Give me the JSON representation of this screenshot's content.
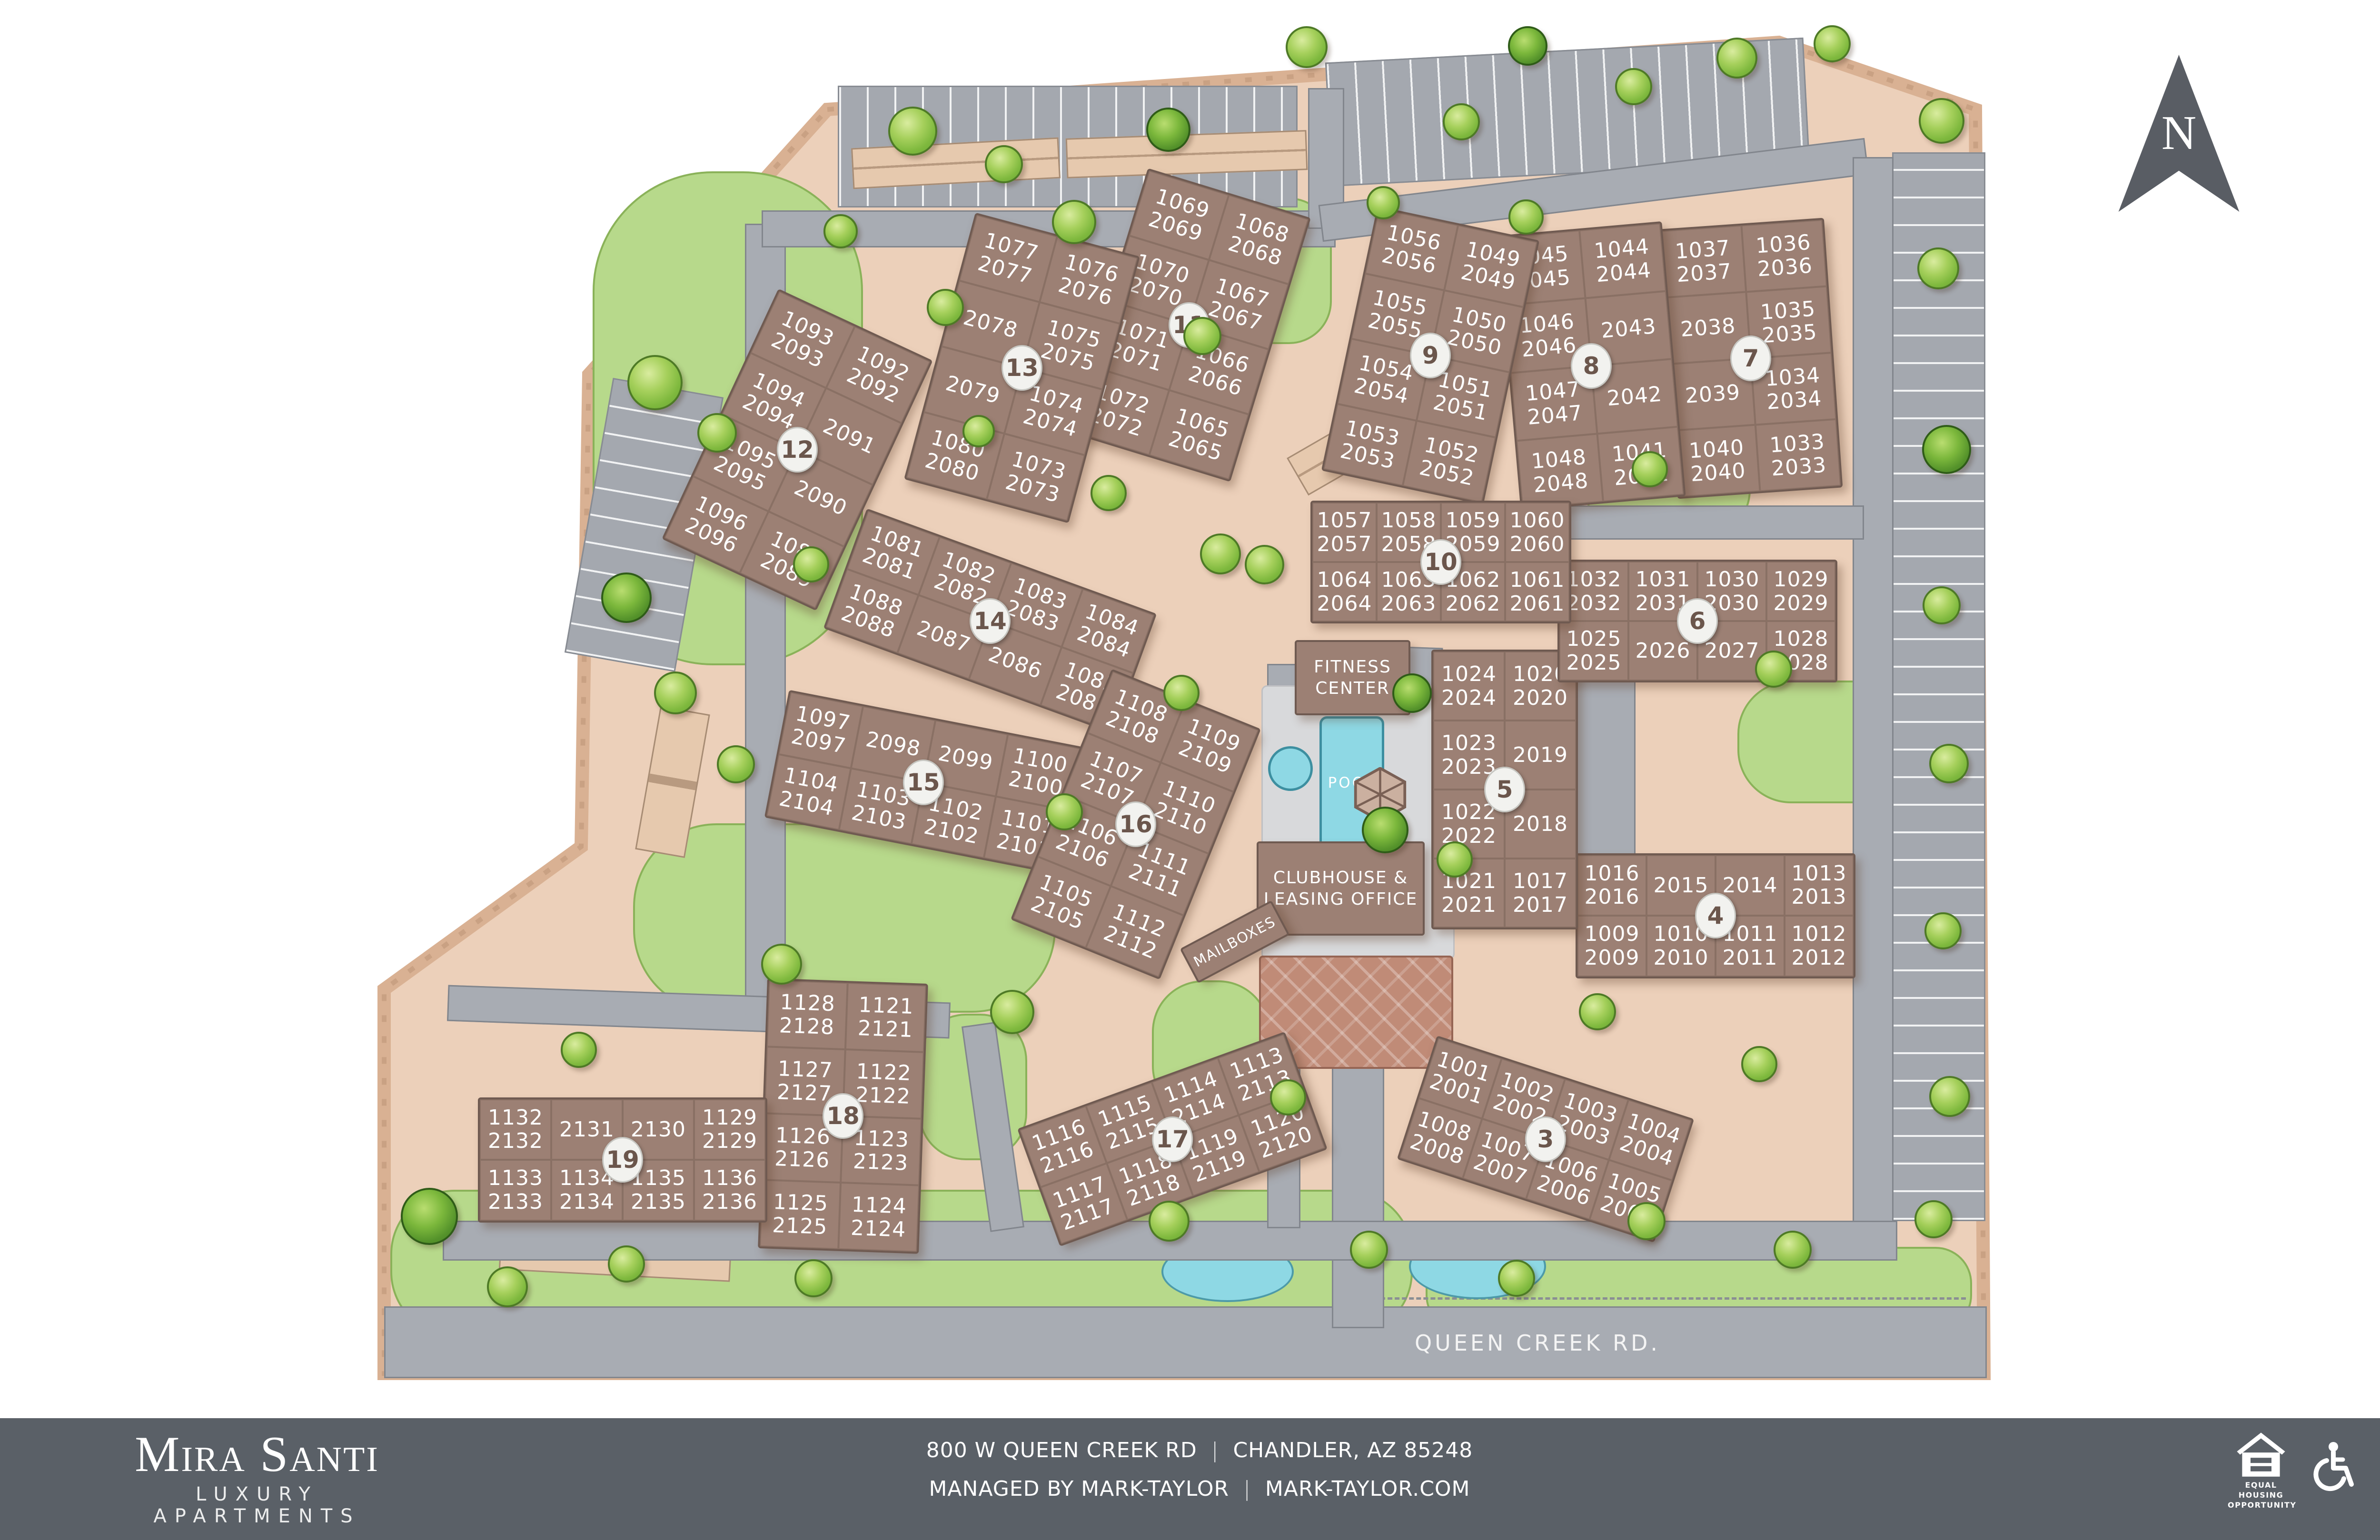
{
  "map": {
    "north_label": "N",
    "road_label": "QUEEN CREEK RD.",
    "amenities": {
      "fitness_line1": "FITNESS",
      "fitness_line2": "CENTER",
      "pool": "POOL",
      "clubhouse_line1": "CLUBHOUSE &",
      "clubhouse_line2": "LEASING OFFICE",
      "mailboxes": "MAILBOXES"
    },
    "buildings": [
      {
        "number": "3",
        "cells": [
          [
            "1001",
            "2001"
          ],
          [
            "1002",
            "2002"
          ],
          [
            "1003",
            "2003"
          ],
          [
            "1004",
            "2004"
          ],
          [
            "1008",
            "2008"
          ],
          [
            "1007",
            "2007"
          ],
          [
            "1006",
            "2006"
          ],
          [
            "1005",
            "2005"
          ]
        ]
      },
      {
        "number": "4",
        "cells": [
          [
            "1016",
            "2016"
          ],
          [
            "2015"
          ],
          [
            "2014"
          ],
          [
            "1013",
            "2013"
          ],
          [
            "1009",
            "2009"
          ],
          [
            "1010",
            "2010"
          ],
          [
            "1011",
            "2011"
          ],
          [
            "1012",
            "2012"
          ]
        ]
      },
      {
        "number": "5",
        "cells": [
          [
            "1024",
            "2024"
          ],
          [
            "1020",
            "2020"
          ],
          [
            "1023",
            "2023"
          ],
          [
            "2019"
          ],
          [
            "1022",
            "2022"
          ],
          [
            "2018"
          ],
          [
            "1021",
            "2021"
          ],
          [
            "1017",
            "2017"
          ]
        ]
      },
      {
        "number": "6",
        "cells": [
          [
            "1032",
            "2032"
          ],
          [
            "1031",
            "2031"
          ],
          [
            "1030",
            "2030"
          ],
          [
            "1029",
            "2029"
          ],
          [
            "1025",
            "2025"
          ],
          [
            "2026"
          ],
          [
            "2027"
          ],
          [
            "1028",
            "2028"
          ]
        ]
      },
      {
        "number": "7",
        "cells": [
          [
            "1037",
            "2037"
          ],
          [
            "1036",
            "2036"
          ],
          [
            "2038"
          ],
          [
            "1035",
            "2035"
          ],
          [
            "2039"
          ],
          [
            "1034",
            "2034"
          ],
          [
            "1040",
            "2040"
          ],
          [
            "1033",
            "2033"
          ]
        ]
      },
      {
        "number": "8",
        "cells": [
          [
            "1045",
            "2045"
          ],
          [
            "1044",
            "2044"
          ],
          [
            "1046",
            "2046"
          ],
          [
            "2043"
          ],
          [
            "1047",
            "2047"
          ],
          [
            "2042"
          ],
          [
            "1048",
            "2048"
          ],
          [
            "1041",
            "2041"
          ]
        ]
      },
      {
        "number": "9",
        "cells": [
          [
            "1056",
            "2056"
          ],
          [
            "1049",
            "2049"
          ],
          [
            "1055",
            "2055"
          ],
          [
            "1050",
            "2050"
          ],
          [
            "1054",
            "2054"
          ],
          [
            "1051",
            "2051"
          ],
          [
            "1053",
            "2053"
          ],
          [
            "1052",
            "2052"
          ]
        ]
      },
      {
        "number": "10",
        "cells": [
          [
            "1057",
            "2057"
          ],
          [
            "1058",
            "2058"
          ],
          [
            "1059",
            "2059"
          ],
          [
            "1060",
            "2060"
          ],
          [
            "1064",
            "2064"
          ],
          [
            "1063",
            "2063"
          ],
          [
            "1062",
            "2062"
          ],
          [
            "1061",
            "2061"
          ]
        ]
      },
      {
        "number": "11",
        "cells": [
          [
            "1069",
            "2069"
          ],
          [
            "1068",
            "2068"
          ],
          [
            "1070",
            "2070"
          ],
          [
            "1067",
            "2067"
          ],
          [
            "1071",
            "2071"
          ],
          [
            "1066",
            "2066"
          ],
          [
            "1072",
            "2072"
          ],
          [
            "1065",
            "2065"
          ]
        ]
      },
      {
        "number": "12",
        "cells": [
          [
            "1093",
            "2093"
          ],
          [
            "1092",
            "2092"
          ],
          [
            "1094",
            "2094"
          ],
          [
            "2091"
          ],
          [
            "1095",
            "2095"
          ],
          [
            "2090"
          ],
          [
            "1096",
            "2096"
          ],
          [
            "1089",
            "2089"
          ]
        ]
      },
      {
        "number": "13",
        "cells": [
          [
            "1077",
            "2077"
          ],
          [
            "1076",
            "2076"
          ],
          [
            "2078"
          ],
          [
            "1075",
            "2075"
          ],
          [
            "2079"
          ],
          [
            "1074",
            "2074"
          ],
          [
            "1080",
            "2080"
          ],
          [
            "1073",
            "2073"
          ]
        ]
      },
      {
        "number": "14",
        "cells": [
          [
            "1081",
            "2081"
          ],
          [
            "1082",
            "2082"
          ],
          [
            "1083",
            "2083"
          ],
          [
            "1084",
            "2084"
          ],
          [
            "1088",
            "2088"
          ],
          [
            "2087"
          ],
          [
            "2086"
          ],
          [
            "1085",
            "2085"
          ]
        ]
      },
      {
        "number": "15",
        "cells": [
          [
            "1097",
            "2097"
          ],
          [
            "2098"
          ],
          [
            "2099"
          ],
          [
            "1100",
            "2100"
          ],
          [
            "1104",
            "2104"
          ],
          [
            "1103",
            "2103"
          ],
          [
            "1102",
            "2102"
          ],
          [
            "1101",
            "2101"
          ]
        ]
      },
      {
        "number": "16",
        "cells": [
          [
            "1108",
            "2108"
          ],
          [
            "1109",
            "2109"
          ],
          [
            "1107",
            "2107"
          ],
          [
            "1110",
            "2110"
          ],
          [
            "1106",
            "2106"
          ],
          [
            "1111",
            "2111"
          ],
          [
            "1105",
            "2105"
          ],
          [
            "1112",
            "2112"
          ]
        ]
      },
      {
        "number": "17",
        "cells": [
          [
            "1116",
            "2116"
          ],
          [
            "1115",
            "2115"
          ],
          [
            "1114",
            "2114"
          ],
          [
            "1113",
            "2113"
          ],
          [
            "1117",
            "2117"
          ],
          [
            "1118",
            "2118"
          ],
          [
            "1119",
            "2119"
          ],
          [
            "1120",
            "2120"
          ]
        ]
      },
      {
        "number": "18",
        "cells": [
          [
            "1128",
            "2128"
          ],
          [
            "1121",
            "2121"
          ],
          [
            "1127",
            "2127"
          ],
          [
            "1122",
            "2122"
          ],
          [
            "1126",
            "2126"
          ],
          [
            "1123",
            "2123"
          ],
          [
            "1125",
            "2125"
          ],
          [
            "1124",
            "2124"
          ]
        ]
      },
      {
        "number": "19",
        "cells": [
          [
            "1132",
            "2132"
          ],
          [
            "2131"
          ],
          [
            "2130"
          ],
          [
            "1129",
            "2129"
          ],
          [
            "1133",
            "2133"
          ],
          [
            "1134",
            "2134"
          ],
          [
            "1135",
            "2135"
          ],
          [
            "1136",
            "2136"
          ]
        ]
      }
    ]
  },
  "footer": {
    "brand_name": "Mira Santi",
    "brand_tagline": "LUXURY APARTMENTS",
    "address_left": "800 W QUEEN CREEK RD",
    "address_right": "CHANDLER, AZ 85248",
    "managed_left": "MANAGED BY MARK-TAYLOR",
    "managed_right": "MARK-TAYLOR.COM",
    "separator": "|",
    "eho_line1": "EQUAL HOUSING",
    "eho_line2": "OPPORTUNITY"
  },
  "colors": {
    "ground": "#ecd0ba",
    "building": "#9c8074",
    "road": "#a8acb3",
    "lawn": "#b7d98b",
    "water": "#8ed8e4",
    "footer_bg": "#5a6067",
    "badge_text": "#6b564c"
  }
}
